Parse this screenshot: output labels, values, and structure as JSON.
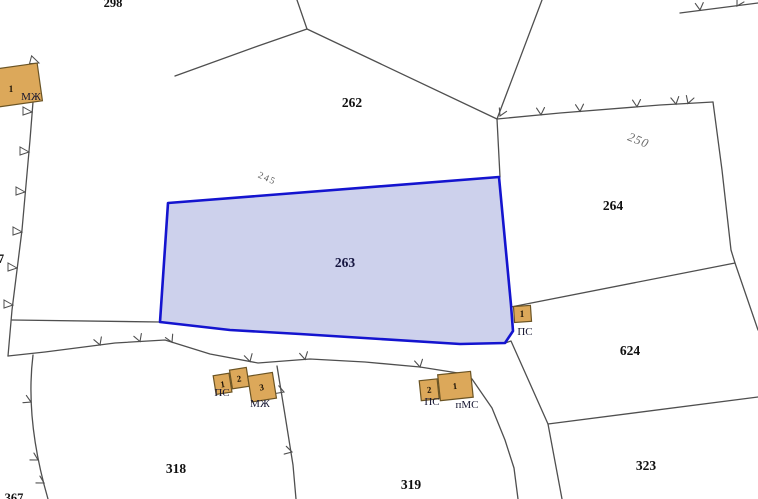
{
  "map": {
    "kind": "cadastral parcel map",
    "background": "#ffffff",
    "boundary_color": "#4f4f4f",
    "selected_parcel": {
      "id": "263",
      "stroke": "#1414cf",
      "fill": "#cdd1ec"
    },
    "building": {
      "fill": "#dca85a",
      "stroke": "#6b5424"
    }
  },
  "parcel_labels": {
    "p262": "262",
    "p263": "263",
    "p264": "264",
    "p624": "624",
    "p318": "318",
    "p319": "319",
    "p323": "323",
    "p298_partial": "298",
    "p367_partial": "367",
    "p7_partial": "7",
    "line245": "245",
    "line250": "250"
  },
  "buildings": {
    "northwest": {
      "number": "1",
      "type": "МЖ"
    },
    "south_cluster": {
      "n1": "1",
      "n2": "2",
      "n3": "3",
      "type_ps": "ПС",
      "type_mzh": "МЖ"
    },
    "southeast_cluster": {
      "n2": "2",
      "n1": "1",
      "type_ps": "ПС",
      "type_pms": "пМС"
    },
    "east": {
      "number": "1",
      "type": "ПС"
    }
  }
}
